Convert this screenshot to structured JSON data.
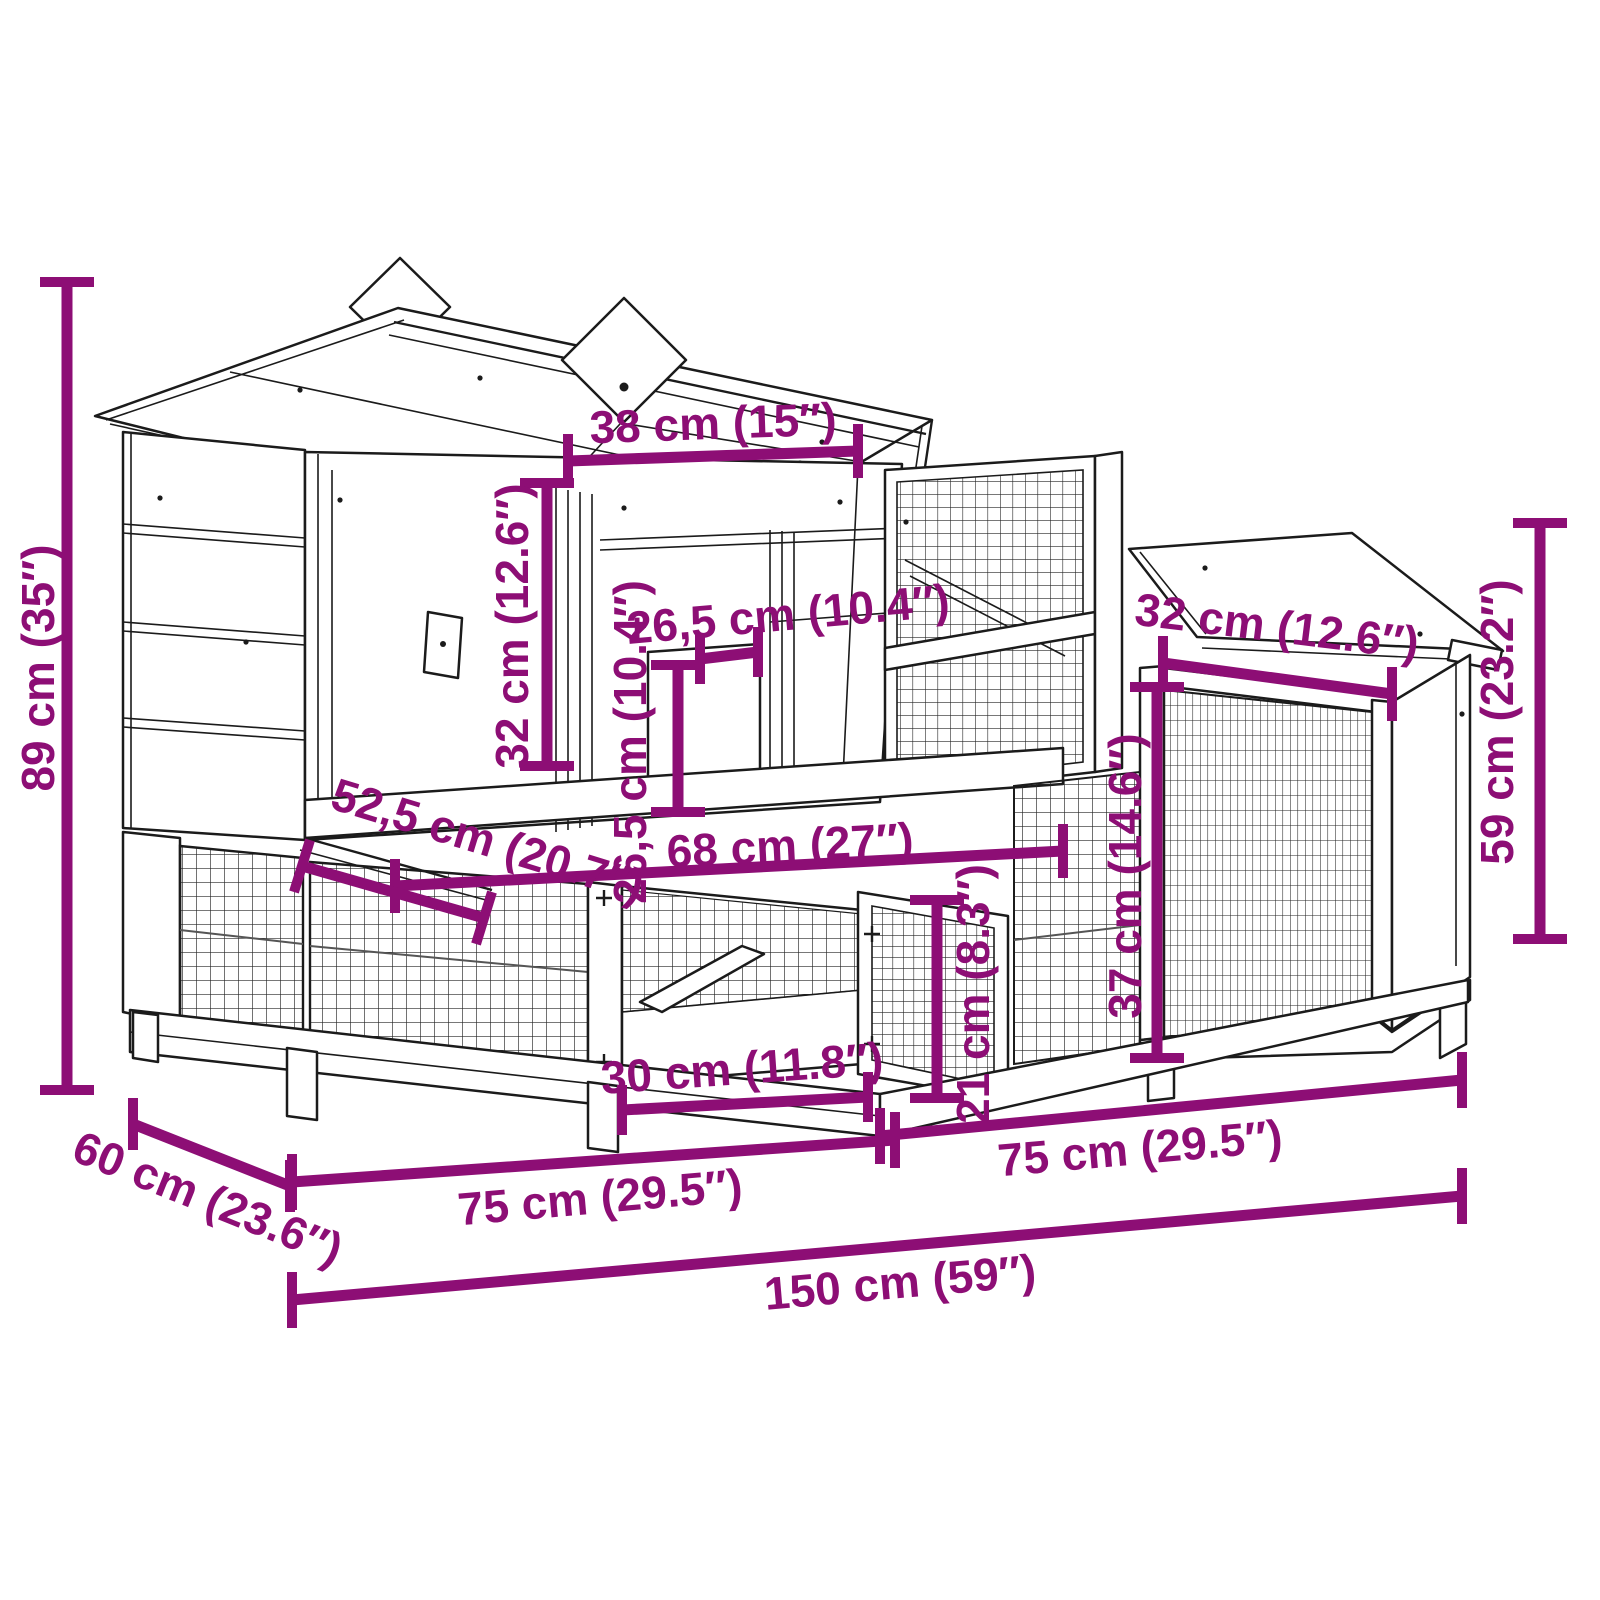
{
  "title": "Rabbit hutch dimension diagram",
  "colors": {
    "dimension": "#8D0E75",
    "line": "#1b1b1b",
    "background": "#ffffff"
  },
  "diagram": {
    "type": "product-dimension-drawing",
    "subject": "two-level wooden rabbit hutch with gable roof, mesh run and side enclosure",
    "overall_width_label": "150 cm (59″)",
    "overall_height_label": "89 cm (35″)",
    "overall_depth_label": "60 cm (23.6″)"
  },
  "dimensions": [
    {
      "id": "height-total",
      "label": "89 cm (35″)",
      "line": {
        "x1": 67,
        "y1": 282,
        "x2": 67,
        "y2": 1090
      },
      "tick": {
        "dx": 27,
        "dy": 0
      },
      "label_pos": {
        "x": 38,
        "y": 668,
        "rot": -90
      }
    },
    {
      "id": "roof-gable-width",
      "label": "38 cm (15″)",
      "line": {
        "x1": 568,
        "y1": 461,
        "x2": 858,
        "y2": 451
      },
      "tick": {
        "dx": 0,
        "dy": 27
      },
      "label_pos": {
        "x": 713,
        "y": 423,
        "rot": -2
      }
    },
    {
      "id": "house-height",
      "label": "32 cm (12.6″)",
      "line": {
        "x1": 547,
        "y1": 483,
        "x2": 547,
        "y2": 766
      },
      "tick": {
        "dx": 27,
        "dy": 0
      },
      "label_pos": {
        "x": 512,
        "y": 626,
        "rot": -90
      }
    },
    {
      "id": "door-height-upper",
      "label": "26,5 cm (10.4″)",
      "line": {
        "x1": 678,
        "y1": 665,
        "x2": 678,
        "y2": 812
      },
      "tick": {
        "dx": 27,
        "dy": 0
      },
      "label_pos": {
        "x": 630,
        "y": 742,
        "rot": -90
      }
    },
    {
      "id": "door-width-upper",
      "label": "26,5 cm (10.4″)",
      "line": {
        "x1": 700,
        "y1": 659,
        "x2": 758,
        "y2": 652
      },
      "tick": {
        "dx": 0,
        "dy": 25
      },
      "label_pos": {
        "x": 788,
        "y": 614,
        "rot": -5
      }
    },
    {
      "id": "annex-roof-width",
      "label": "32 cm (12.6″)",
      "line": {
        "x1": 1163,
        "y1": 663,
        "x2": 1392,
        "y2": 694
      },
      "tick": {
        "dx": 0,
        "dy": 27
      },
      "label_pos": {
        "x": 1277,
        "y": 626,
        "rot": 7
      }
    },
    {
      "id": "annex-height",
      "label": "59 cm (23.2″)",
      "line": {
        "x1": 1540,
        "y1": 523,
        "x2": 1540,
        "y2": 939
      },
      "tick": {
        "dx": 27,
        "dy": 0
      },
      "label_pos": {
        "x": 1497,
        "y": 722,
        "rot": -90
      }
    },
    {
      "id": "annex-front-height",
      "label": "37 cm (14.6″)",
      "line": {
        "x1": 1157,
        "y1": 687,
        "x2": 1157,
        "y2": 1058
      },
      "tick": {
        "dx": 27,
        "dy": 0
      },
      "label_pos": {
        "x": 1125,
        "y": 876,
        "rot": -90
      }
    },
    {
      "id": "run-door-height",
      "label": "21 cm (8.3″)",
      "line": {
        "x1": 937,
        "y1": 900,
        "x2": 937,
        "y2": 1098
      },
      "tick": {
        "dx": 27,
        "dy": 0
      },
      "label_pos": {
        "x": 973,
        "y": 994,
        "rot": -90
      }
    },
    {
      "id": "platform-width",
      "label": "68 cm (27″)",
      "line": {
        "x1": 395,
        "y1": 886,
        "x2": 1063,
        "y2": 851
      },
      "tick": {
        "dx": 0,
        "dy": 27
      },
      "label_pos": {
        "x": 790,
        "y": 845,
        "rot": -3
      }
    },
    {
      "id": "platform-depth",
      "label": "52,5 cm (20.7″)",
      "line": {
        "x1": 302,
        "y1": 866,
        "x2": 484,
        "y2": 918
      },
      "tick": {
        "dx": -8,
        "dy": 26
      },
      "label_pos": {
        "x": 488,
        "y": 840,
        "rot": 17
      }
    },
    {
      "id": "run-door-width",
      "label": "30 cm (11.8″)",
      "line": {
        "x1": 622,
        "y1": 1110,
        "x2": 868,
        "y2": 1097
      },
      "tick": {
        "dx": 0,
        "dy": 25
      },
      "label_pos": {
        "x": 742,
        "y": 1068,
        "rot": -4
      }
    },
    {
      "id": "base-width-left",
      "label": "75 cm (29.5″)",
      "line": {
        "x1": 292,
        "y1": 1182,
        "x2": 895,
        "y2": 1140
      },
      "tick": {
        "dx": 0,
        "dy": 28
      },
      "label_pos": {
        "x": 600,
        "y": 1197,
        "rot": -5
      }
    },
    {
      "id": "base-width-right",
      "label": "75 cm (29.5″)",
      "line": {
        "x1": 880,
        "y1": 1136,
        "x2": 1462,
        "y2": 1080
      },
      "tick": {
        "dx": 0,
        "dy": 28
      },
      "label_pos": {
        "x": 1140,
        "y": 1148,
        "rot": -5
      }
    },
    {
      "id": "base-depth",
      "label": "60 cm (23.6″)",
      "line": {
        "x1": 133,
        "y1": 1124,
        "x2": 290,
        "y2": 1186
      },
      "tick": {
        "dx": 0,
        "dy": 26
      },
      "label_pos": {
        "x": 208,
        "y": 1198,
        "rot": 22
      }
    },
    {
      "id": "total-width",
      "label": "150 cm (59″)",
      "line": {
        "x1": 292,
        "y1": 1300,
        "x2": 1462,
        "y2": 1196
      },
      "tick": {
        "dx": 0,
        "dy": 28
      },
      "label_pos": {
        "x": 900,
        "y": 1282,
        "rot": -5
      }
    }
  ]
}
